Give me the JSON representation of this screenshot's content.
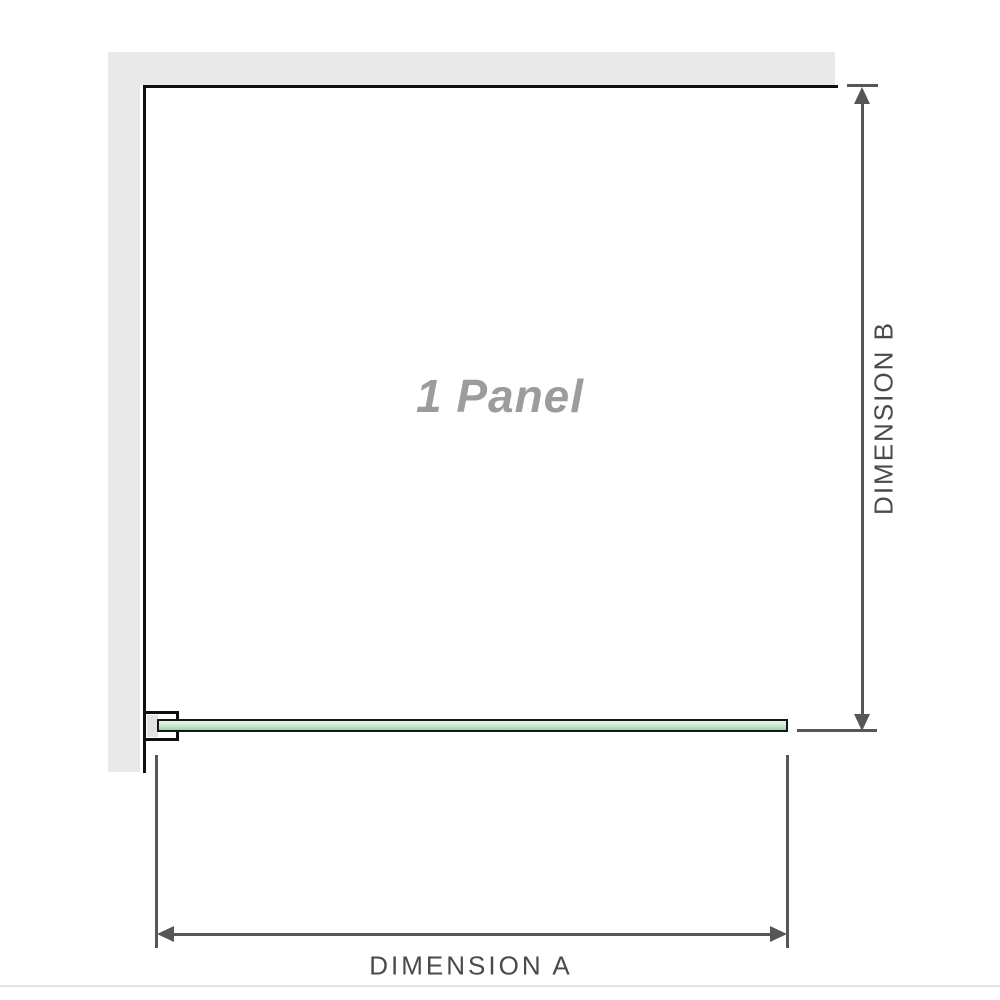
{
  "diagram": {
    "panel_label": "1 Panel",
    "dimension_a": {
      "label": "DIMENSION A"
    },
    "dimension_b": {
      "label": "DIMENSION B"
    }
  },
  "colors": {
    "wall_fill": "#e9e9e9",
    "wall_line": "#0f0f0f",
    "dim_color": "#565656",
    "label_color": "#4a4a4a",
    "panel_label_color": "#9c9c9c",
    "glass_border": "#161616",
    "glass_top": "#e7f4e9",
    "glass_mid": "#cfebd5",
    "glass_bottom": "#98d2a7",
    "clamp_gap": "#e2e2e2",
    "divider": "#e3e3e3"
  }
}
